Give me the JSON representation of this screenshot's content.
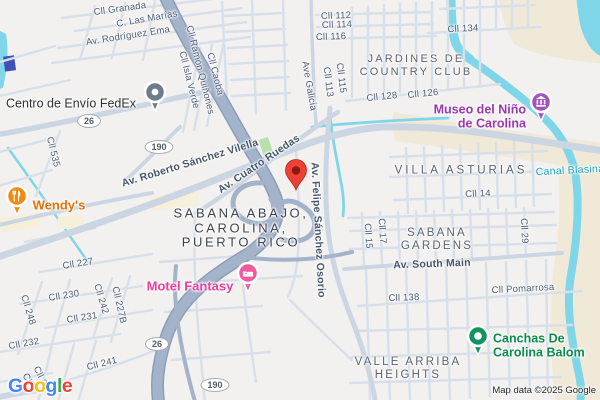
{
  "palette": {
    "bg": "#f2f1ef",
    "road-minor": "#d8dfe9",
    "road-major": "#ccd6e2",
    "highway-fill": "#a3b3ca",
    "highway-edge": "#8b9db8",
    "water": "#7fd6e8",
    "terrain": "#f0e9d8",
    "park": "#b7e0ad",
    "building": "#f6efda",
    "street-text": "#4b5b74",
    "area-text": "#5c6370",
    "locality-text": "#3d4450",
    "water-text": "#1aa3c1",
    "pin-red": "#ea4335",
    "pin-red-dark": "#8a1a10",
    "poi-fedex": "#6e7b8a",
    "poi-fedex-text": "#2d3134",
    "poi-wendys": "#ef8b12",
    "poi-wendys-text": "#e8710a",
    "poi-motel": "#ef5ba1",
    "poi-motel-text": "#ee3d9f",
    "poi-museo": "#a551be",
    "poi-museo-text": "#9c36b0",
    "poi-canchas": "#109561",
    "poi-canchas-text": "#0d8a4f",
    "shield-border": "#a6adb4",
    "shield-text": "#555d66",
    "google-blue": "#4285F4",
    "google-red": "#EA4335",
    "google-yellow": "#FBBC05",
    "google-green": "#34A853",
    "attribution-text": "#1f2328"
  },
  "streets": {
    "granada": "Cll Granada",
    "las_marias": "C. Las Marías",
    "rodriguez_ema": "Av. Rodríguez Ema",
    "caoba": "Cll Caoba",
    "ramon_quinones": "Cll Ramón Quiñones",
    "isla_verde": "Cll Isla Verde",
    "c112": "Cll 112",
    "c114": "Cll 114",
    "c116": "Cll 116",
    "ave_galicia": "Ave Galicia",
    "c115": "Cll 115",
    "c113": "Cll 113",
    "c128": "Cll 128",
    "c126": "Cll 126",
    "c134": "Cll 134",
    "c535": "Cll 535",
    "roberto": "Av. Roberto Sánchez Vilella",
    "cuatro_ruedas": "Av. Cuatro Ruedas",
    "felipe": "Av. Felipe Sánchez Osorio",
    "c14": "Cll 14",
    "south_main": "Av. South Main",
    "c29": "Cll 29",
    "c17": "Cll 17",
    "c15": "Cll 15",
    "pomarrosa": "Cll Pomarrosa",
    "c138": "Cll 138",
    "c227": "Cll 227",
    "c230": "Cll 230",
    "c231": "Cll 231",
    "c232": "Cll 232",
    "c241": "Cll 241",
    "c242": "Cll 242",
    "c227b": "Cll 227B",
    "c248": "Cll 248",
    "c2a": "Cll 2",
    "c2b": "Cll 2"
  },
  "areas": {
    "jardines": {
      "lines": [
        "JARDINES DE",
        "COUNTRY CLUB"
      ]
    },
    "villa_asturias": "VILLA ASTURIAS",
    "sabana_gardens": {
      "lines": [
        "SABANA",
        "GARDENS"
      ]
    },
    "sabana_abajo": {
      "lines": [
        "SABANA ABAJO,",
        "CAROLINA,",
        "PUERTO RICO"
      ]
    },
    "valle_arriba": {
      "lines": [
        "VALLE ARRIBA",
        "HEIGHTS"
      ]
    },
    "canal_blasina": "Canal Blasina"
  },
  "pois": {
    "fedex": {
      "label": "Centro de Envío FedEx"
    },
    "wendys": {
      "label": "Wendy's"
    },
    "motel": {
      "label": "Motel Fantasy"
    },
    "museo": {
      "lines": [
        "Museo del Niño",
        "de Carolina"
      ]
    },
    "canchas": {
      "lines": [
        "Canchas De",
        "Carolina Balom"
      ]
    }
  },
  "shields": {
    "r26": "26",
    "r190": "190"
  },
  "logo": {
    "letters": [
      "G",
      "o",
      "o",
      "g",
      "l",
      "e"
    ]
  },
  "attribution": "Map data ©2025 Google"
}
